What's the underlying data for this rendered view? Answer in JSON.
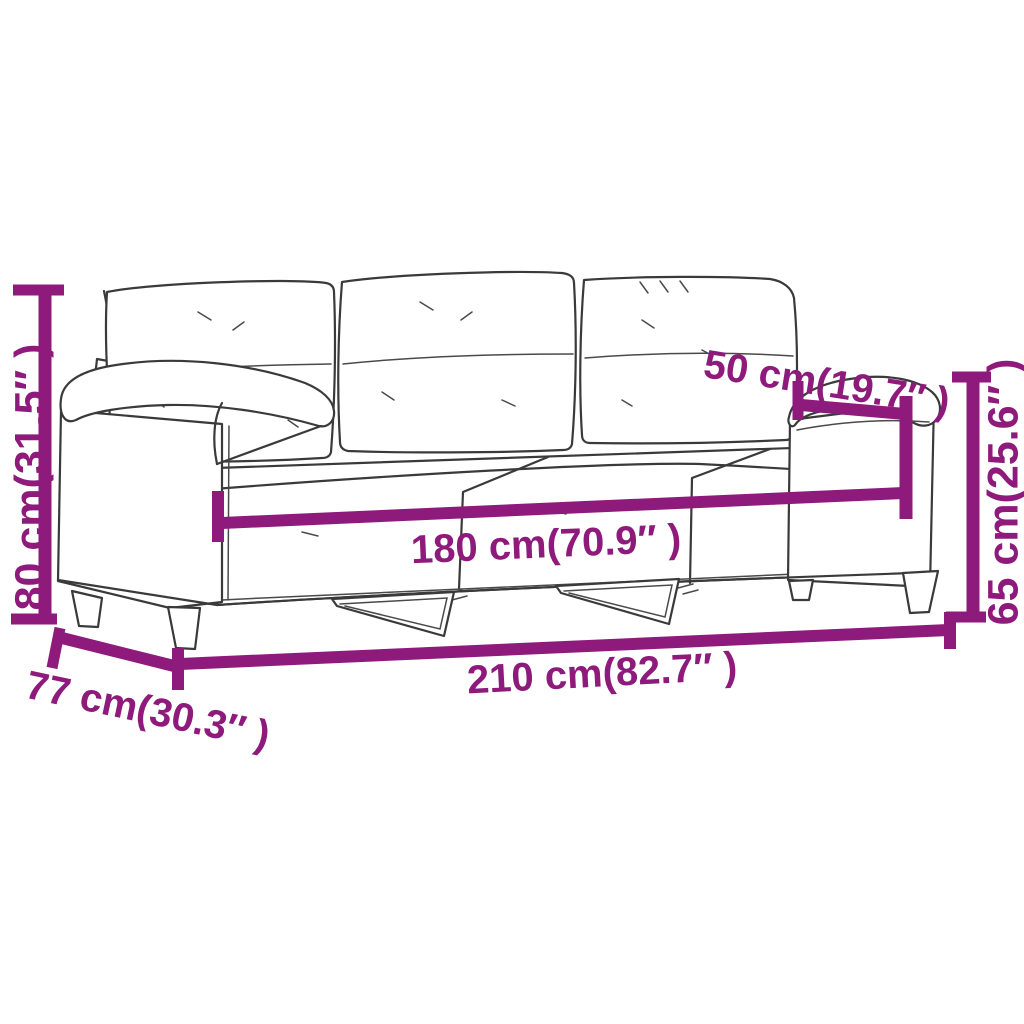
{
  "figure": {
    "kind": "product-dimension-diagram",
    "subject": "3-seater sofa line drawing with measurement annotations",
    "background_color": "#ffffff",
    "accent_color": "#8e1a7c",
    "sketch_color": "#3a3a3a"
  },
  "dimensions": {
    "overall_height": {
      "cm": "80 cm",
      "inch": "31.5″",
      "label": "80 cm(31.5″ )"
    },
    "arm_height": {
      "cm": "65 cm",
      "inch": "25.6″",
      "label": "65 cm(25.6″ )"
    },
    "armrest_depth": {
      "cm": "50 cm",
      "inch": "19.7″",
      "label": "50 cm(19.7″ )"
    },
    "seat_width": {
      "cm": "180 cm",
      "inch": "70.9″",
      "label": "180 cm(70.9″ )"
    },
    "overall_width": {
      "cm": "210 cm",
      "inch": "82.7″",
      "label": "210 cm(82.7″ )"
    },
    "overall_depth": {
      "cm": "77 cm",
      "inch": "30.3″",
      "label": "77 cm(30.3″ )"
    }
  }
}
